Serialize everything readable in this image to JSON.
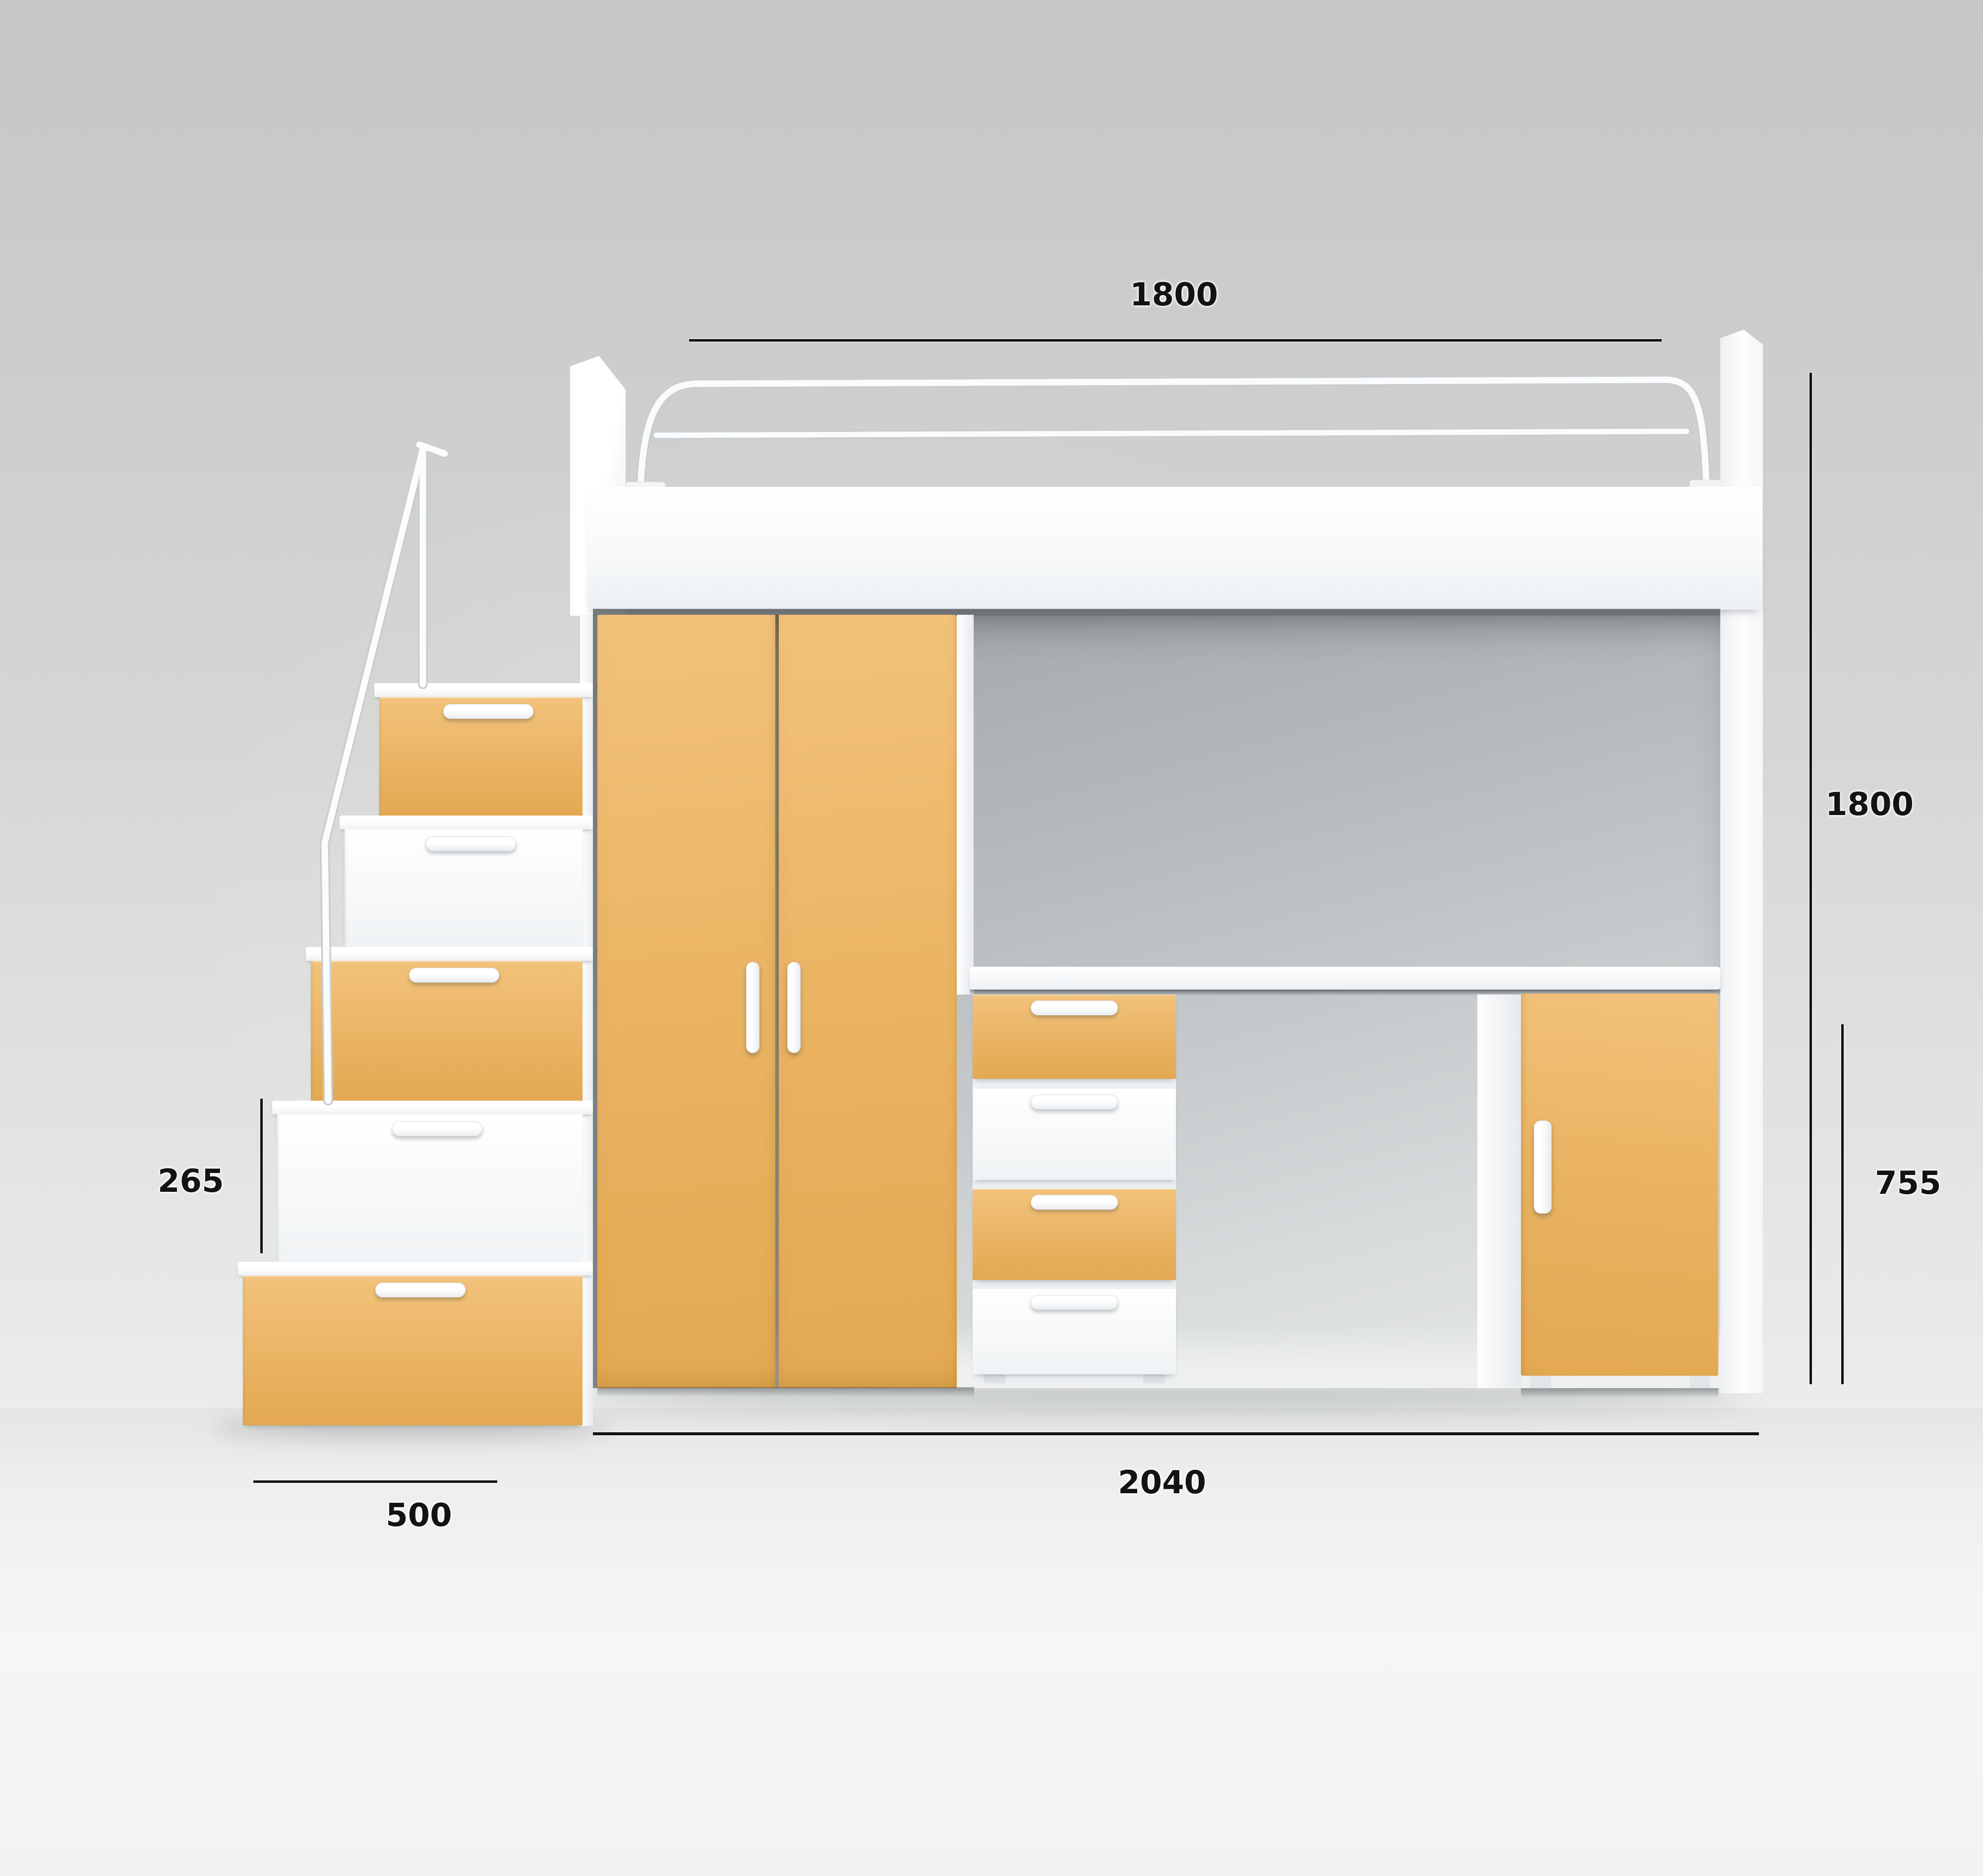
{
  "scene": {
    "kind": "furniture-dimension-diagram",
    "product": "loft bed with wardrobe, desk, drawer pedestal, side cabinet and storage stairs"
  },
  "palette": {
    "accent_hi": "#F2C27B",
    "accent": "#EBB565",
    "accent_lo": "#E3A851",
    "furniture_white": "#FAFBFC",
    "wall": "#D2D3D1",
    "line": "#131313"
  },
  "dimensions": {
    "top_width": "1800",
    "right_height": "1800",
    "desk_height": "755",
    "step_rise": "265",
    "stair_depth": "500",
    "base_width": "2040"
  },
  "furniture": {
    "stair_drawers": [
      {
        "color": "amber"
      },
      {
        "color": "white"
      },
      {
        "color": "amber"
      },
      {
        "color": "white"
      },
      {
        "color": "amber"
      }
    ],
    "desk_drawers": [
      {
        "color": "amber"
      },
      {
        "color": "white"
      },
      {
        "color": "amber"
      },
      {
        "color": "white"
      }
    ],
    "wardrobe_doors": 2
  }
}
